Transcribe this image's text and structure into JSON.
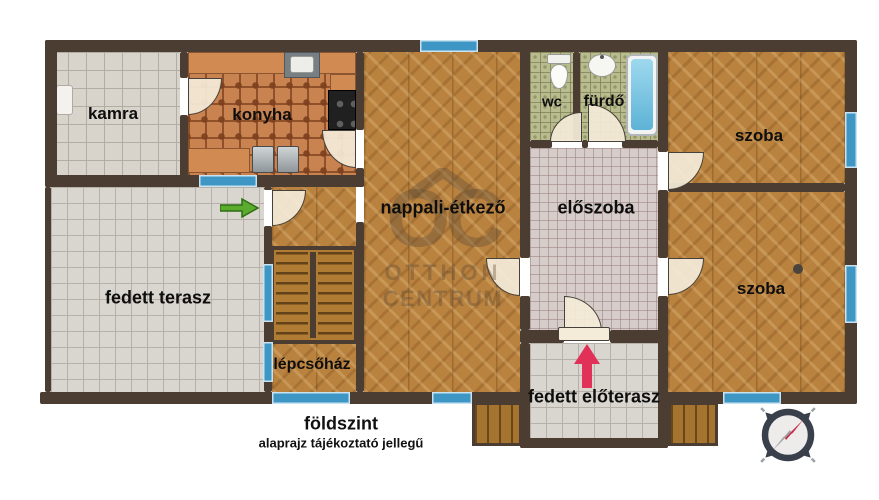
{
  "rooms": {
    "kamra": "kamra",
    "konyha": "konyha",
    "nappali_etkezo": "nappali-étkező",
    "wc": "wc",
    "furdo": "fürdő",
    "eloszoba": "előszoba",
    "szoba_felso": "szoba",
    "szoba_also": "szoba",
    "fedett_terasz": "fedett terasz",
    "lepcsohaz": "lépcsőház",
    "fedett_eloterasz": "fedett előterasz"
  },
  "captions": {
    "floor": "földszint",
    "disclaimer": "alaprajz tájékoztató jellegű"
  },
  "watermark": {
    "logo": "OC",
    "line1": "OTTHON",
    "line2": "CENTRUM"
  },
  "icons": {
    "compass": "compass-rose",
    "entry_arrow": "pink-up-arrow",
    "terrace_door_arrow": "green-right-arrow"
  },
  "colors": {
    "wall": "#4b3d32",
    "window": "#3e96c5",
    "wood": "#b9823f",
    "tile_light": "#d8d4cc",
    "tile_hall": "#d6ccca",
    "tile_bath": "#b9bc8e",
    "tile_kitchen": "#c98350",
    "door": "#f4ebd8",
    "arrow_green": "#55a62c",
    "arrow_pink": "#e23158",
    "compass_red": "#c52745"
  }
}
